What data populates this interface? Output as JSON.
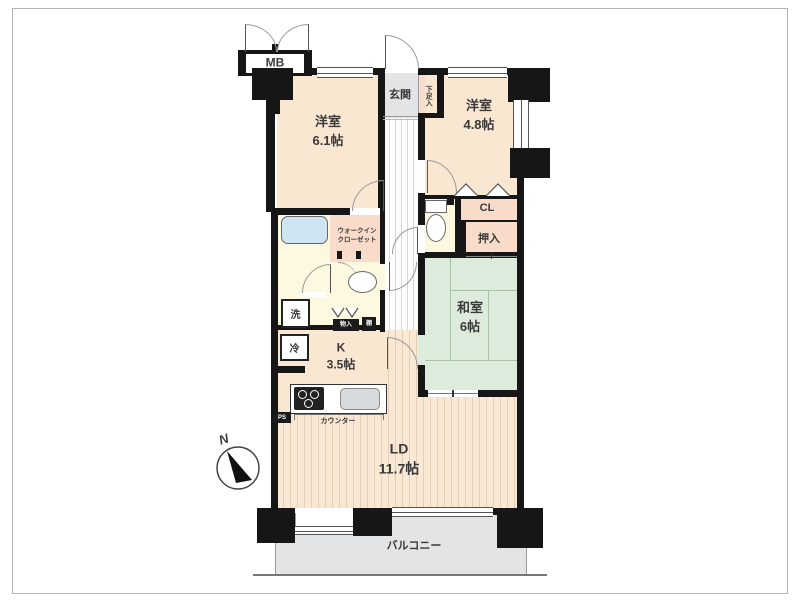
{
  "plan": {
    "mb": "MB",
    "genkan": "玄関",
    "shoe_cabinet": "下足入",
    "bedroom1": {
      "name": "洋室",
      "size": "6.1帖"
    },
    "bedroom2": {
      "name": "洋室",
      "size": "4.8帖"
    },
    "closet_cl": "CL",
    "oshiire": "押入",
    "washitsu": {
      "name": "和室",
      "size": "6帖"
    },
    "wic": {
      "line1": "ウォークイン",
      "line2": "クローゼット"
    },
    "laundry": "洗",
    "fridge": "冷",
    "storage_small": "物入",
    "shelf": "棚",
    "pipe_space": "PS",
    "kitchen": {
      "name": "K",
      "size": "3.5帖"
    },
    "counter": "カウンター",
    "living_dining": {
      "name": "LD",
      "size": "11.7帖"
    },
    "balcony": "バルコニー",
    "compass_north": "N"
  },
  "colors": {
    "wall": "#161616",
    "room_cream": "#f9e7d2",
    "closet_pink": "#f8dbc9",
    "wet_area_yellow": "#fcf9e0",
    "tatami_green": "#dcebdc",
    "entrance_gray": "#e3e4e6",
    "tub_blue": "#cfe4f3"
  }
}
